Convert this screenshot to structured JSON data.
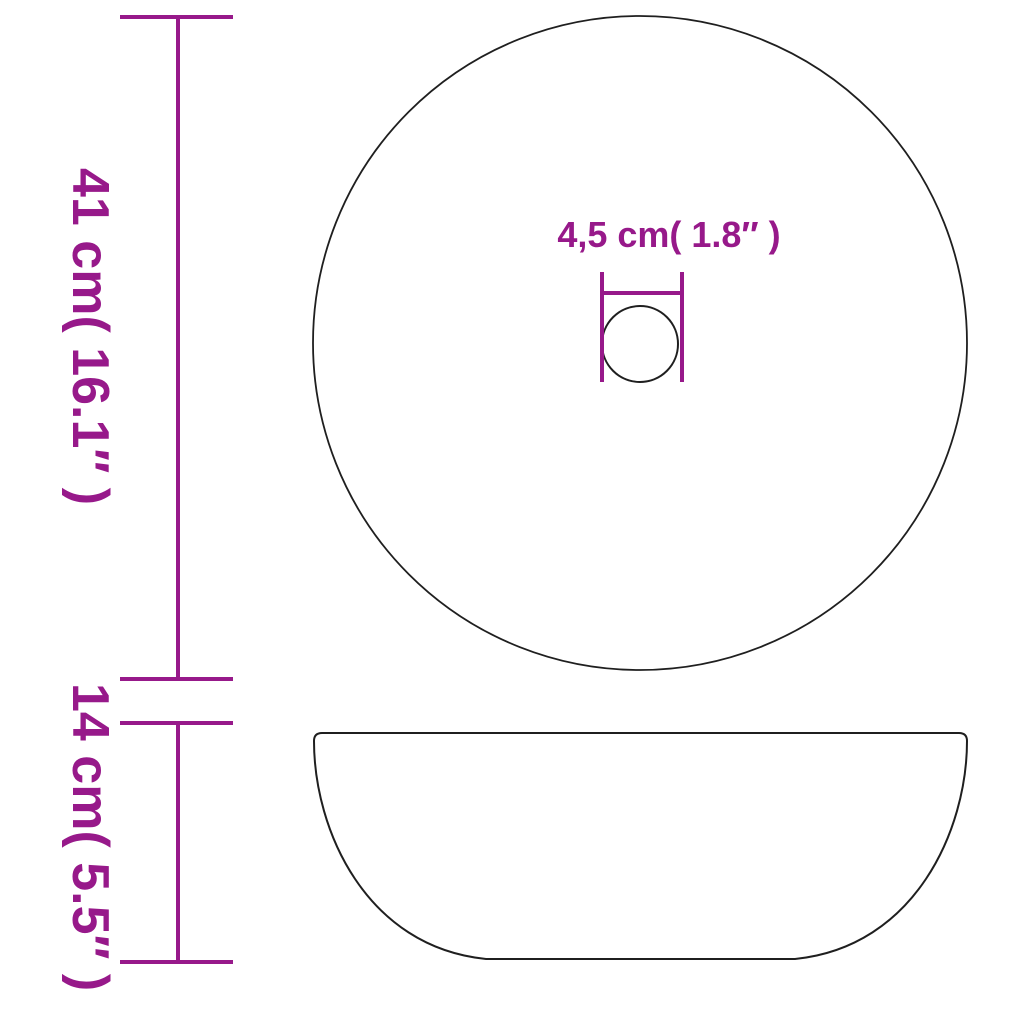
{
  "colors": {
    "background": "#ffffff",
    "accent": "#97198a",
    "outline": "#1f1f1f"
  },
  "diagram": {
    "kind": "round washbasin dimension drawing",
    "views": [
      "top view with drain hole",
      "side profile view"
    ],
    "labels": {
      "diameter": "41 cm( 16.1″  )",
      "height": "14 cm( 5.5″  )",
      "drain": "4,5 cm( 1.8″  )"
    },
    "measurements": {
      "diameter_cm": "41",
      "diameter_in": "16.1",
      "height_cm": "14",
      "height_in": "5.5",
      "drain_cm": "4,5",
      "drain_in": "1.8"
    }
  }
}
